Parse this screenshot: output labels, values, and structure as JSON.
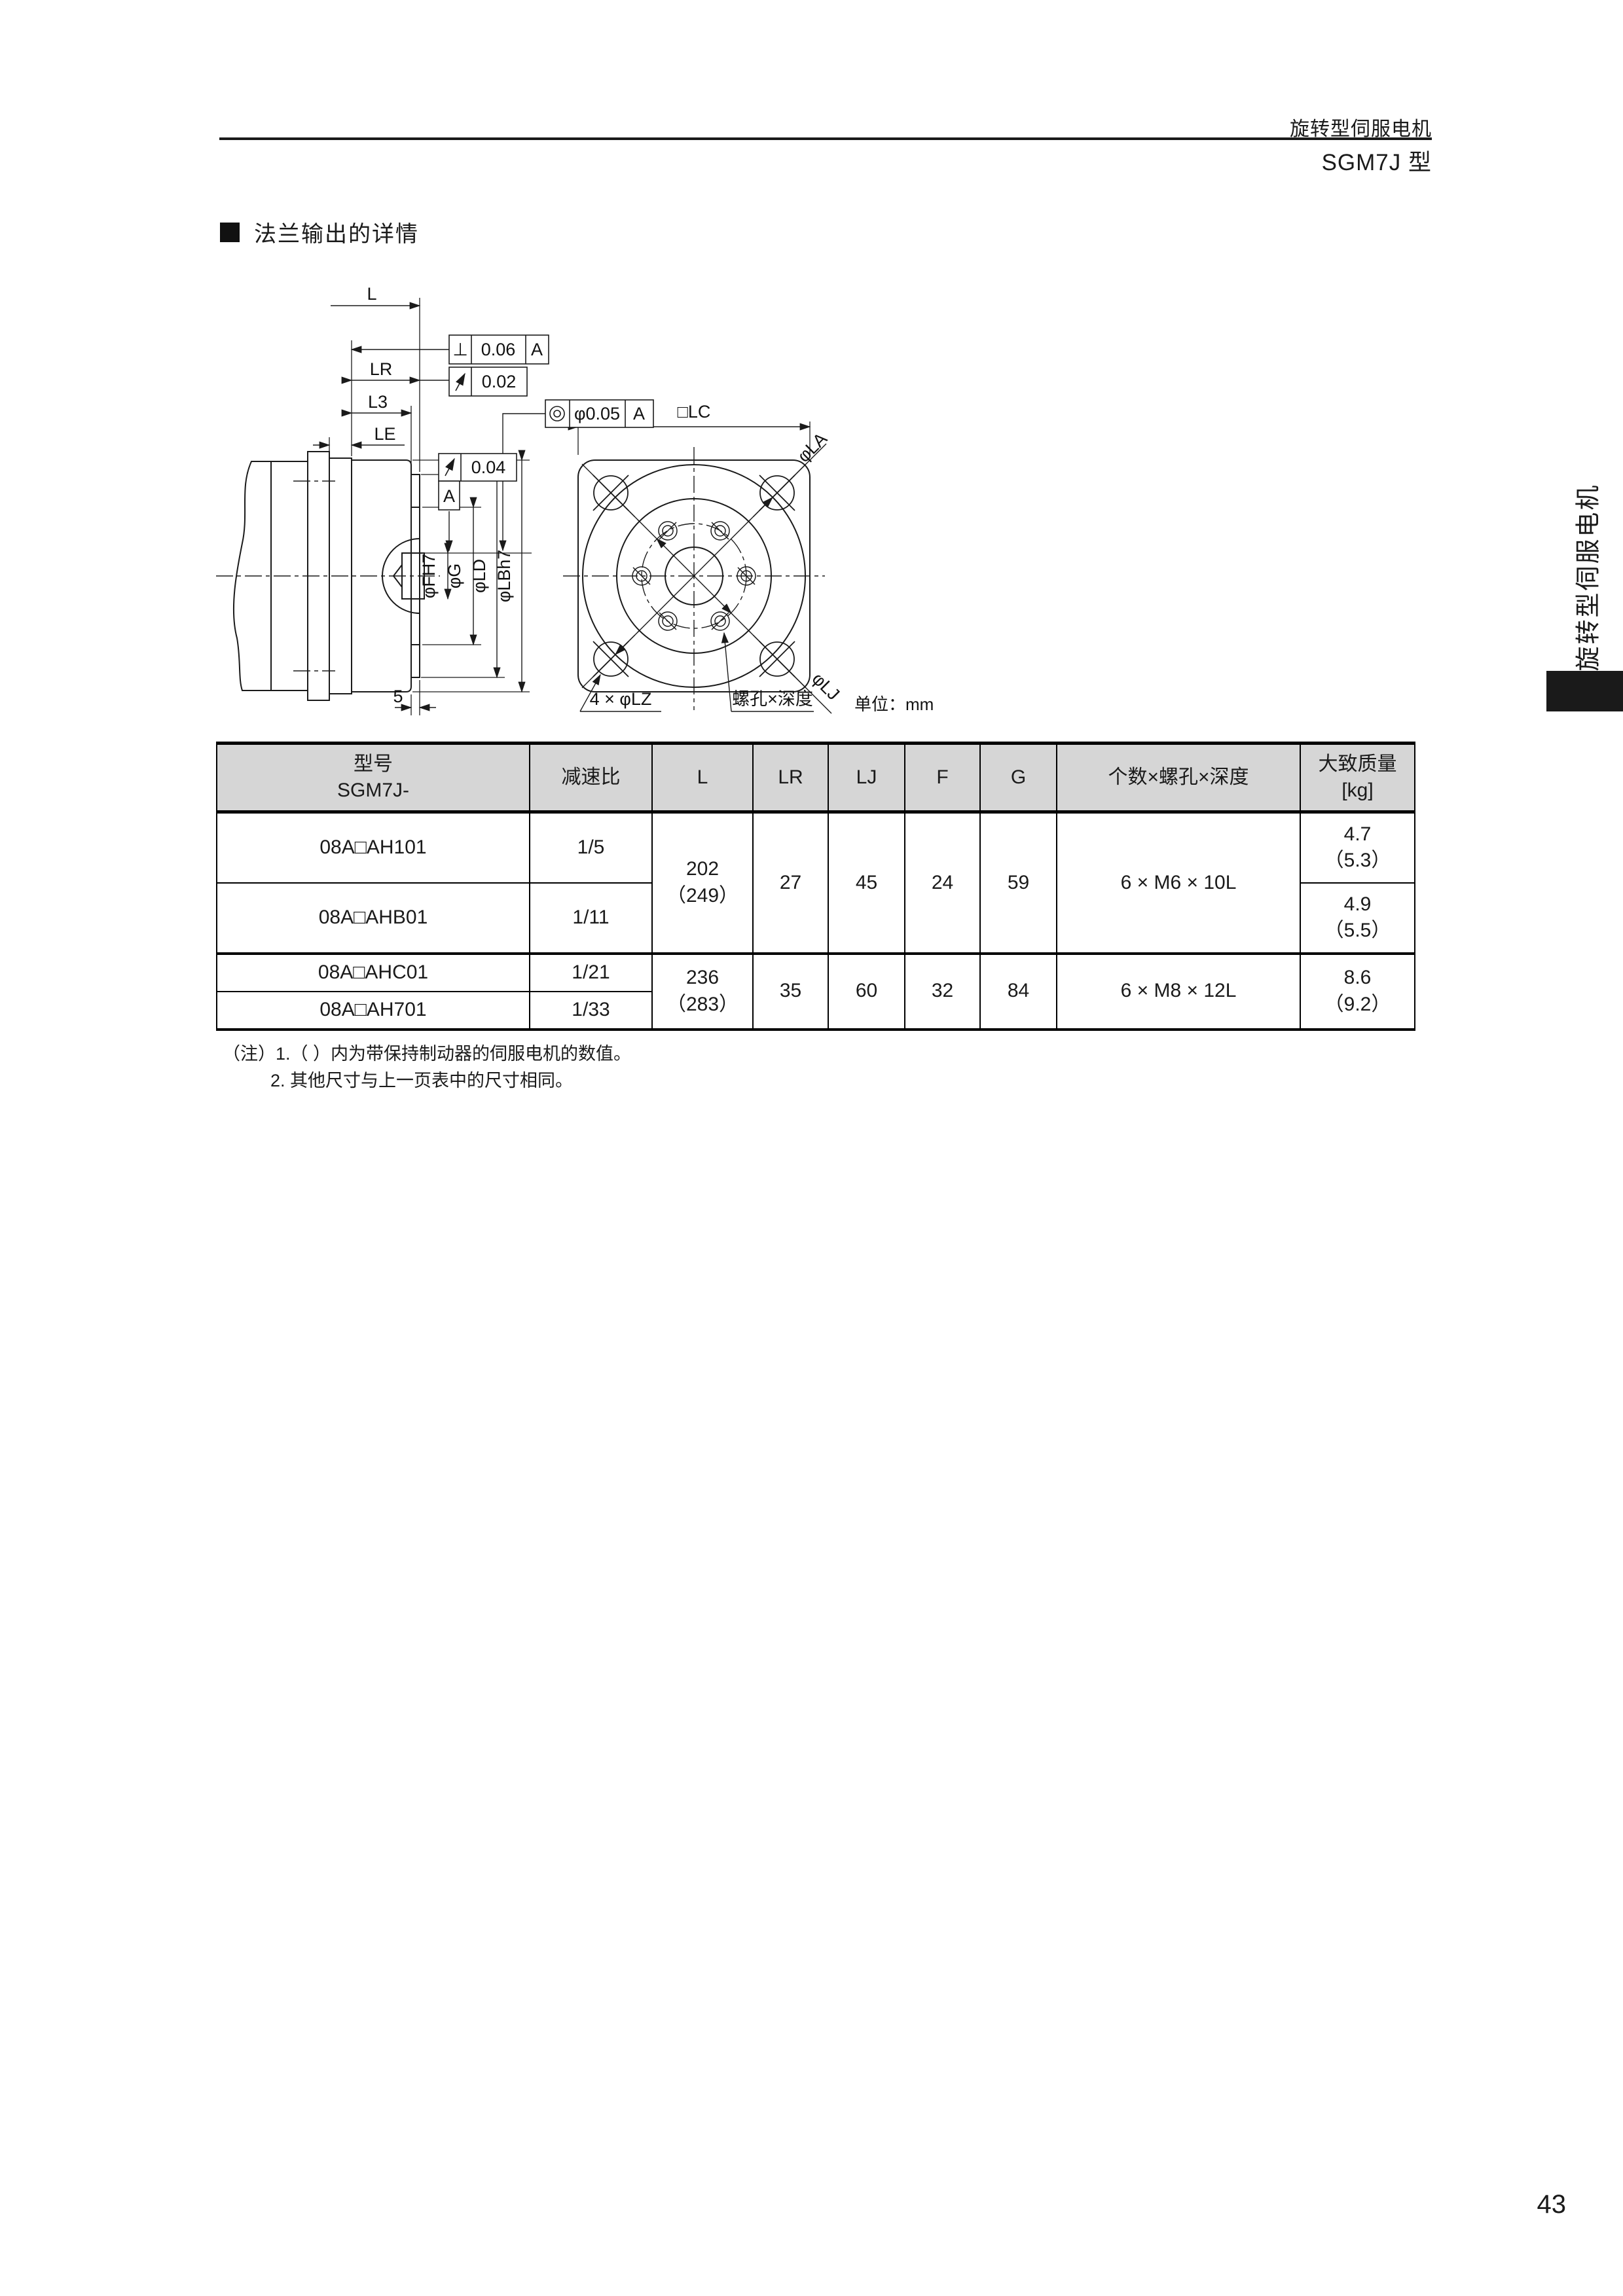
{
  "header": {
    "title": "旋转型伺服电机",
    "subtitle": "SGM7J 型"
  },
  "section": {
    "title": "法兰输出的详情"
  },
  "drawing": {
    "labels": {
      "l": "L",
      "lr": "LR",
      "l3": "L3",
      "le": "LE",
      "five": "5",
      "lc": "□LC",
      "la": "φLA",
      "lj": "φLJ",
      "fh7": "φFH7",
      "g": "φG",
      "ld": "φLD",
      "lbh7": "φLBh7",
      "lz": "4 × φLZ",
      "tap": "螺孔×深度",
      "unit": "单位：mm"
    },
    "tolerances": {
      "perp_sym": "⊥",
      "perp_val": "0.06",
      "runout_val1": "0.02",
      "runout_val2": "0.04",
      "conc_val": "φ0.05",
      "datum": "A"
    }
  },
  "table": {
    "header": {
      "model1": "型号",
      "model2": "SGM7J-",
      "ratio": "减速比",
      "l": "L",
      "lr": "LR",
      "lj": "LJ",
      "f": "F",
      "g": "G",
      "screws": "个数×螺孔×深度",
      "mass1": "大致质量",
      "mass2": "[kg]"
    },
    "groups": [
      {
        "l1": "202",
        "l2": "（249）",
        "lr": "27",
        "lj": "45",
        "f": "24",
        "g": "59",
        "screws": "6 × M6 × 10L"
      },
      {
        "l1": "236",
        "l2": "（283）",
        "lr": "35",
        "lj": "60",
        "f": "32",
        "g": "84",
        "screws": "6 × M8 × 12L"
      }
    ],
    "rows": [
      {
        "model": "08A□AH101",
        "ratio": "1/5",
        "mass1": "4.7",
        "mass2": "（5.3）"
      },
      {
        "model": "08A□AHB01",
        "ratio": "1/11",
        "mass1": "4.9",
        "mass2": "（5.5）"
      },
      {
        "model": "08A□AHC01",
        "ratio": "1/21",
        "mass1": "8.6",
        "mass2": "（9.2）"
      },
      {
        "model": "08A□AH701",
        "ratio": "1/33"
      }
    ]
  },
  "notes": {
    "n1": "（注）1.（ ）内为带保持制动器的伺服电机的数值。",
    "n2": "2. 其他尺寸与上一页表中的尺寸相同。"
  },
  "sidebar": {
    "label": "旋转型伺服电机"
  },
  "footer": {
    "page": "43"
  },
  "colors": {
    "ink": "#1a1a1a",
    "table_header_bg": "#d6d6d6"
  }
}
